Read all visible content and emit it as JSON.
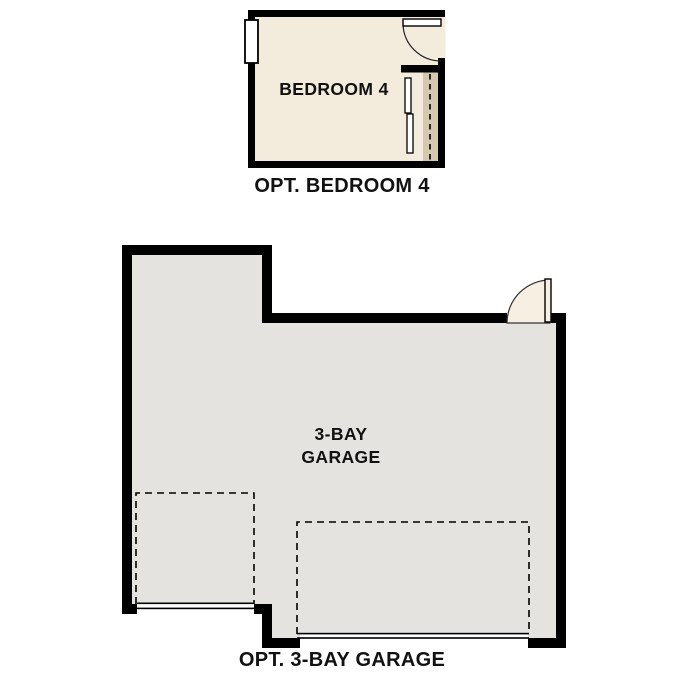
{
  "page": {
    "background": "#ffffff"
  },
  "colors": {
    "wall": "#000000",
    "bedroom_floor": "#f3ecdd",
    "garage_floor": "#e4e3e0",
    "closet_shelf": "#d4c8b1",
    "door_fill": "#f6efe2",
    "fixture_white": "#ffffff",
    "text": "#111111"
  },
  "bedroom_plan": {
    "room_label": "BEDROOM 4",
    "caption": "OPT. BEDROOM 4"
  },
  "garage_plan": {
    "room_label_lines": [
      "3-BAY",
      "GARAGE"
    ],
    "caption": "OPT. 3-BAY GARAGE"
  }
}
